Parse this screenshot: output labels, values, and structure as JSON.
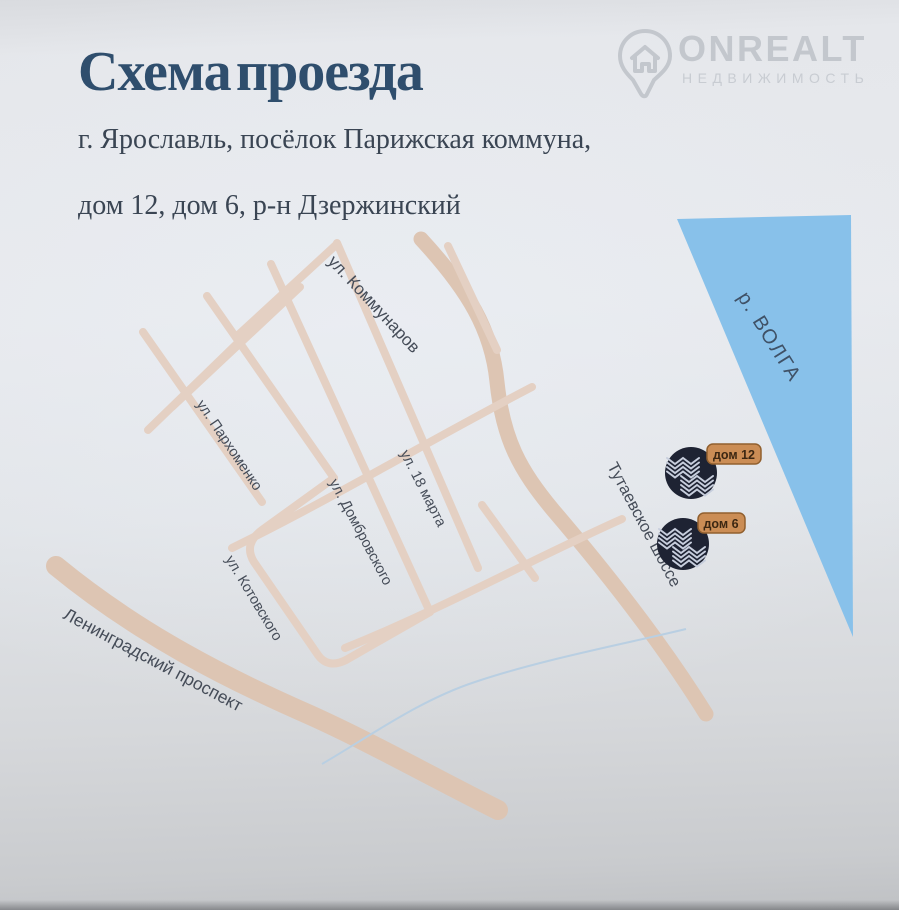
{
  "page": {
    "title": "Схема проезда",
    "subtitle_line1": "г. Ярославль, посёлок Парижская коммуна,",
    "subtitle_line2": "дом 12, дом 6, р-н Дзержинский"
  },
  "logo": {
    "brand": "ONREALT",
    "tagline": "НЕДВИЖИМОСТЬ"
  },
  "map": {
    "river_label": "р. ВОЛГА",
    "street_labels": [
      {
        "id": "kommunarov",
        "label": "ул. Коммунаров"
      },
      {
        "id": "parkhomenko",
        "label": "ул. Пархоменко"
      },
      {
        "id": "18-marta",
        "label": "ул. 18 марта"
      },
      {
        "id": "dombrovskogo",
        "label": "ул. Домбровского"
      },
      {
        "id": "kotovskogo",
        "label": "ул. Котовского"
      },
      {
        "id": "tutaevskoe",
        "label": "Тутаевское шоссе"
      },
      {
        "id": "leningradsky",
        "label": "Ленинградский проспект"
      }
    ],
    "markers": [
      {
        "label": "дом 12"
      },
      {
        "label": "дом 6"
      }
    ]
  },
  "colors": {
    "title": "#2f4e6d",
    "river": "#88c1ea",
    "river_label": "#3f5166",
    "road": "#e4d0c3",
    "road_major": "#ddc5b3",
    "stream": "#b9cfe2",
    "street_label": "#454c58",
    "marker": "#1e2333",
    "marker_wave": "#c7cedd",
    "badge_bg": "#cb8d55",
    "badge_border": "#91602f",
    "badge_text": "#3c2712",
    "logo_gray": "#c3c7cd"
  }
}
